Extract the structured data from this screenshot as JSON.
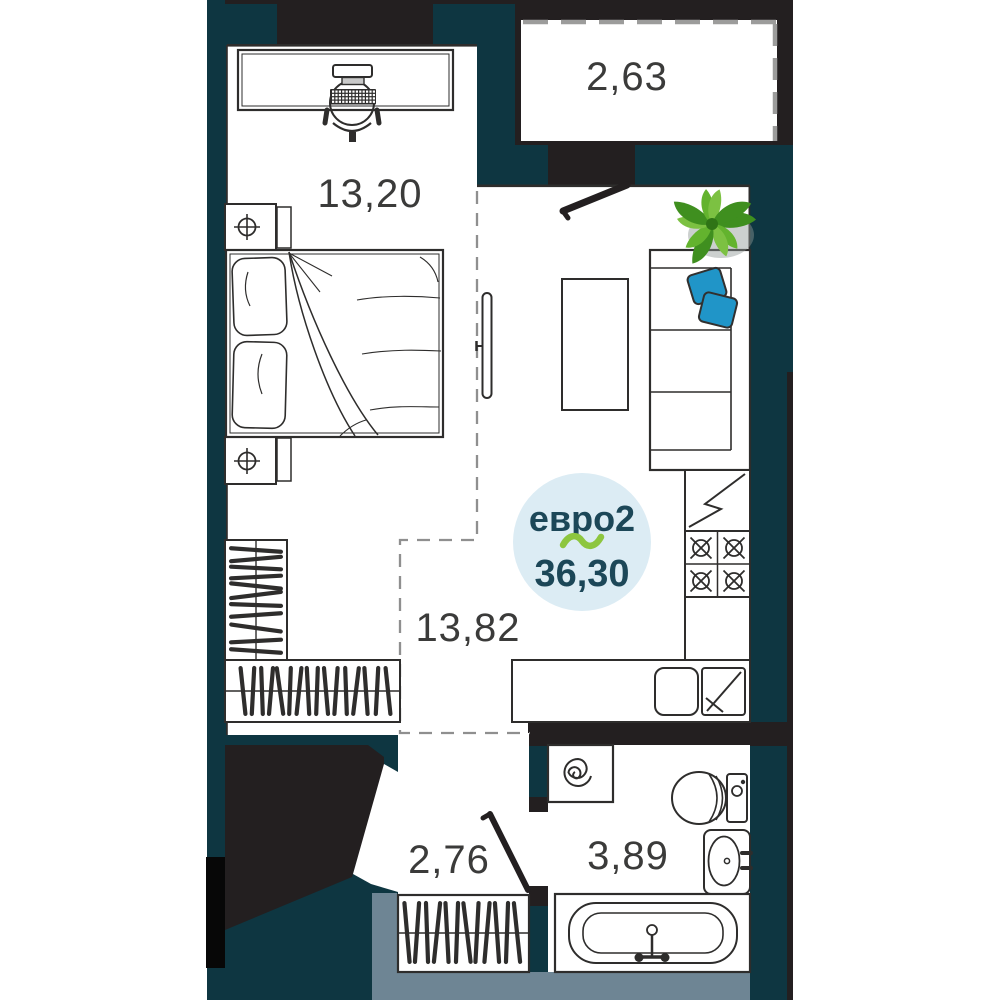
{
  "plan_badge": {
    "layout_type": "евро2",
    "total_area": "36,30"
  },
  "rooms": {
    "bedroom": {
      "area": "13,20"
    },
    "balcony": {
      "area": "2,63"
    },
    "kitchen_living": {
      "area": "13,82"
    },
    "hallway": {
      "area": "2,76"
    },
    "bathroom": {
      "area": "3,89"
    }
  },
  "colors": {
    "page_background": "#ffffff",
    "building_teal": "#0e3641",
    "wall_black": "#231f20",
    "entry_slate": "#6e8594",
    "glazing_gray": "#9c9c9b",
    "badge_fill": "#dcecf4",
    "badge_text": "#1c4758",
    "tilde_green": "#8dc63f",
    "pillow_blue": "#2095c8",
    "label_gray": "#3b3b3a"
  }
}
